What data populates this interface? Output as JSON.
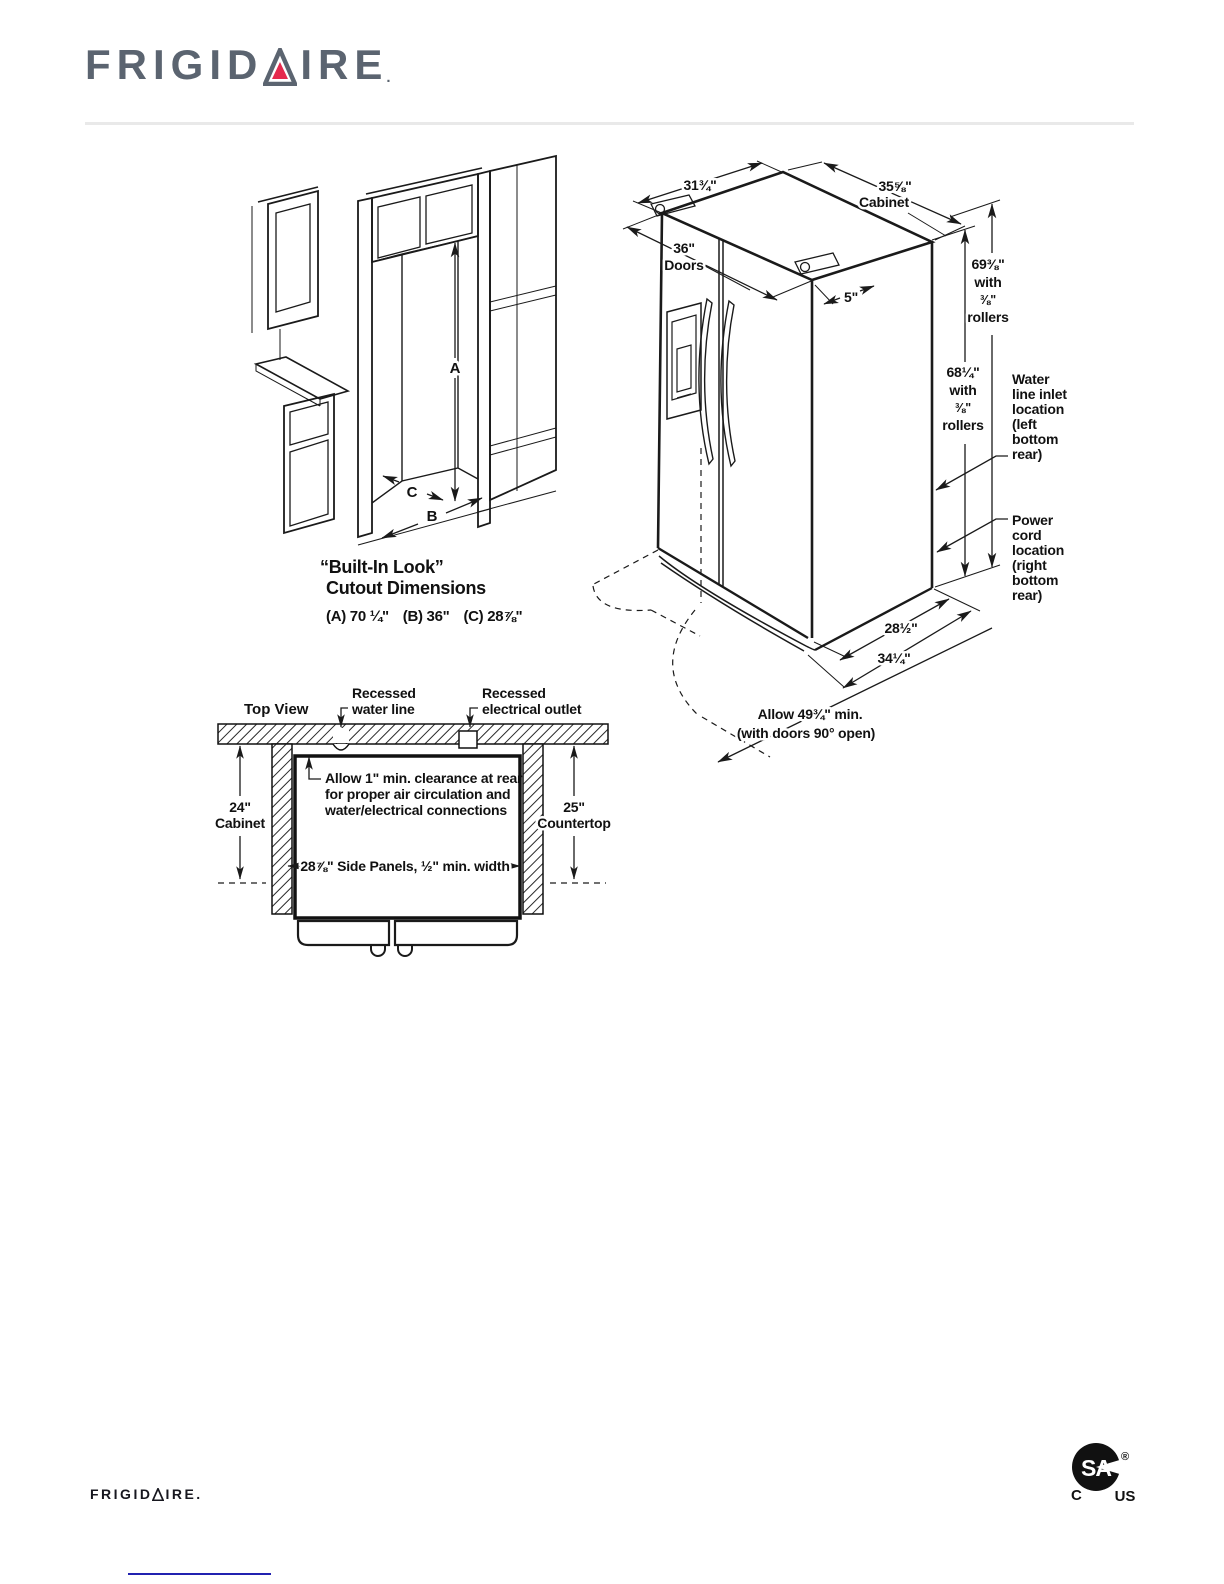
{
  "logo": {
    "left": "FRIGID",
    "right": "IRE",
    "mark": "."
  },
  "cutout": {
    "title1": "“Built-In Look”",
    "title2": "Cutout Dimensions",
    "dim_a": "(A) 70 ¼\"",
    "dim_b": "(B) 36\"",
    "dim_c": "(C) 28⅞\"",
    "label_a": "A",
    "label_b": "B",
    "label_c": "C"
  },
  "fridge": {
    "top_width": "31¾\"",
    "cabinet_width": [
      "35⅝\"",
      "Cabinet"
    ],
    "doors_width": [
      "36\"",
      "Doors"
    ],
    "hinge_offset": "5\"",
    "height_with_hinges": [
      "69⅜\"",
      "with",
      "⅜\"",
      "rollers"
    ],
    "height_cabinet": [
      "68¼\"",
      "with",
      "⅜\"",
      "rollers"
    ],
    "water_inlet": [
      "Water",
      "line inlet",
      "location",
      "(left",
      "bottom",
      "rear)"
    ],
    "power_cord": [
      "Power",
      "cord",
      "location",
      "(right",
      "bottom",
      "rear)"
    ],
    "depth_cabinet": "28½\"",
    "depth_doors": "34¼\"",
    "door_swing": [
      "Allow 49¾\" min.",
      "(with doors 90° open)"
    ]
  },
  "topview": {
    "title": "Top View",
    "water_line": [
      "Recessed",
      "water line"
    ],
    "outlet": [
      "Recessed",
      "electrical outlet"
    ],
    "clearance": [
      "Allow 1\" min. clearance at rear",
      "for proper air circulation and",
      "water/electrical connections"
    ],
    "cabinet_depth": [
      "24\"",
      "Cabinet"
    ],
    "countertop_depth": [
      "25\"",
      "Countertop"
    ],
    "side_panels": "28⅞\" Side Panels, ½\" min. width"
  },
  "footer": {
    "brand_left": "FRIGID",
    "brand_right": "IRE",
    "brand_mark": ".",
    "csa_monogram": "SA",
    "csa_c": "C",
    "csa_us": "US",
    "csa_reg": "®"
  },
  "colors": {
    "accent_red": "#e5294d",
    "logo_gray": "#5b6470",
    "line": "#1a1a1a",
    "rule_gray": "#e9e9e9",
    "link_blue": "#2121b0"
  }
}
